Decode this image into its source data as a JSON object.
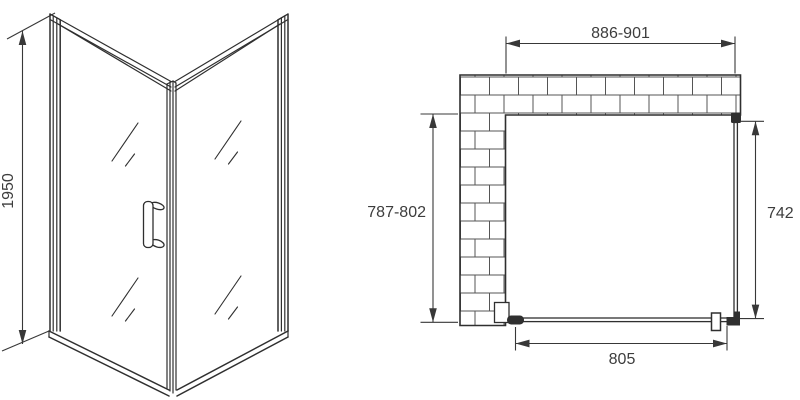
{
  "colors": {
    "line": "#2f2f2f",
    "dim": "#383838",
    "text": "#3d3d3d",
    "brick": "#555555",
    "bg": "#ffffff"
  },
  "side_view": {
    "height_label": "1950"
  },
  "plan_view": {
    "width_label": "886-901",
    "depth_label": "787-802",
    "panel_label": "742",
    "door_label": "805"
  }
}
